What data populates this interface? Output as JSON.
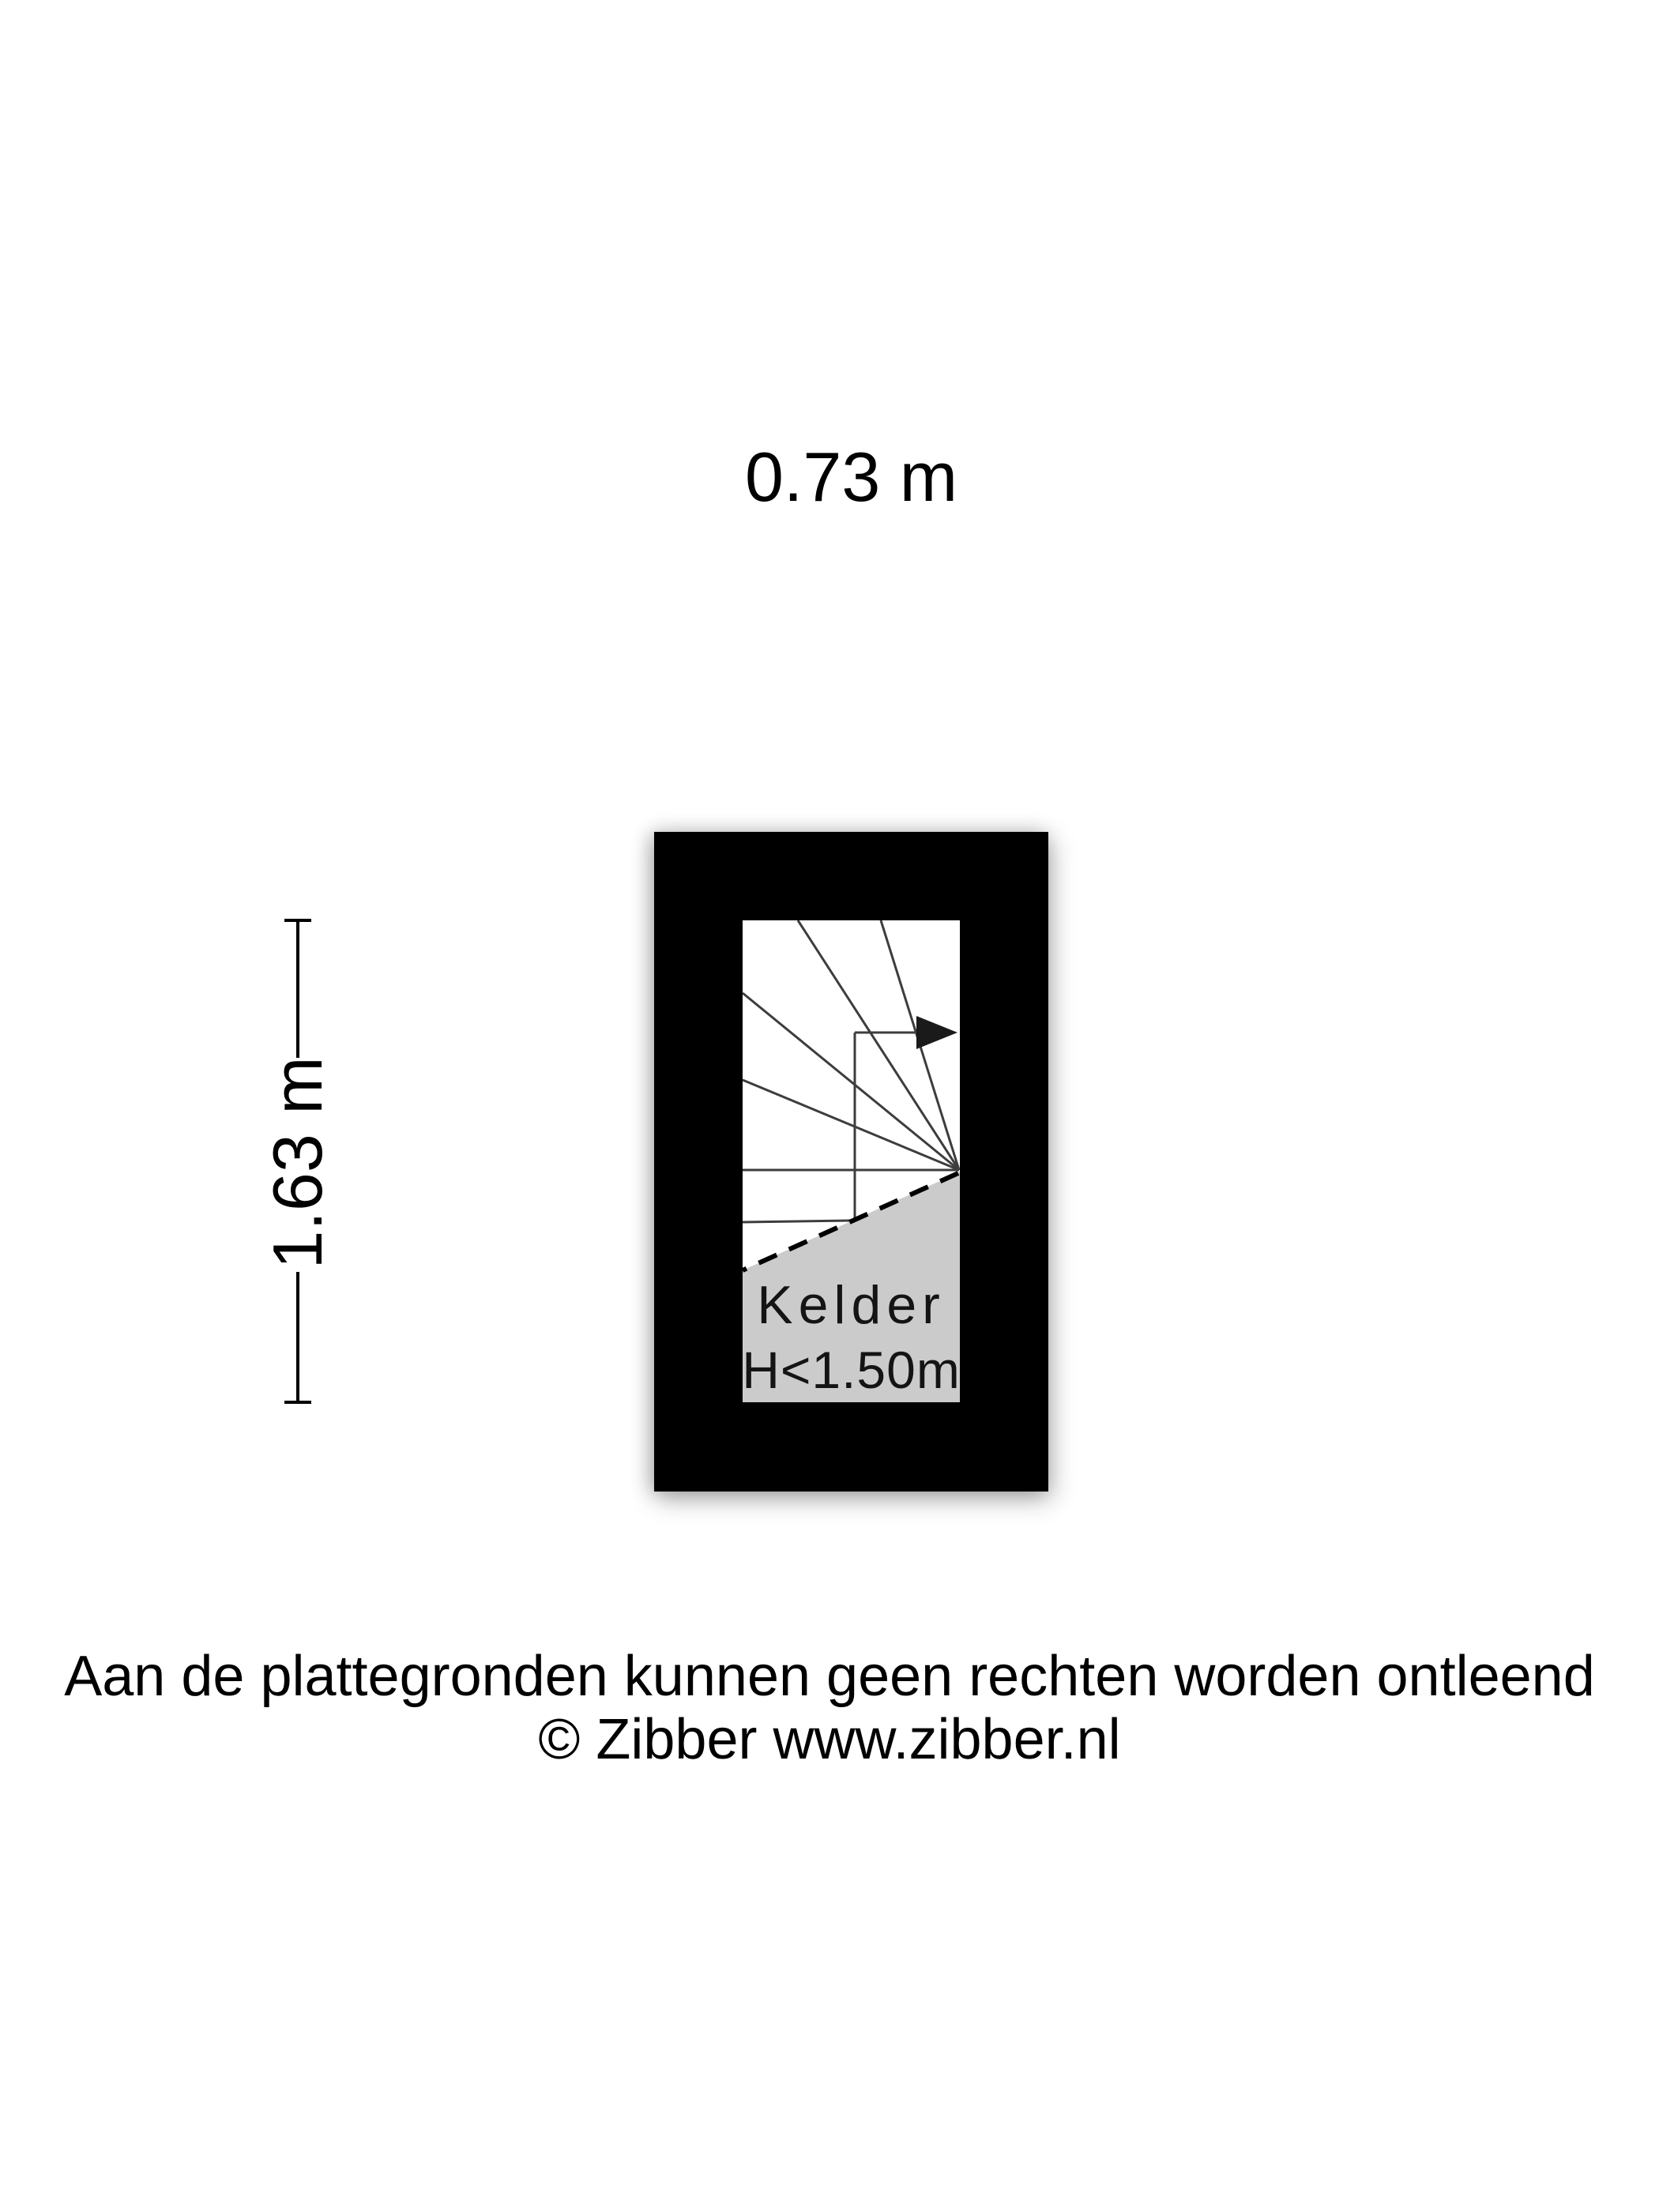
{
  "page": {
    "background": "#ffffff"
  },
  "dimensions": {
    "width_label": "0.73 m",
    "height_label": "1.63 m"
  },
  "plan": {
    "room_label": "Kelder",
    "clearance_label": "H<1.50m",
    "colors": {
      "wall": "#000000",
      "floor": "#ffffff",
      "low_headroom_fill": "#cbcbcb",
      "stair_line": "#3d3d3d",
      "dashed_boundary": "#000000",
      "arrow": "#1a1a1a"
    }
  },
  "footer": {
    "disclaimer": "Aan de plattegronden kunnen geen rechten worden ontleend",
    "copyright": "© Zibber www.zibber.nl"
  }
}
